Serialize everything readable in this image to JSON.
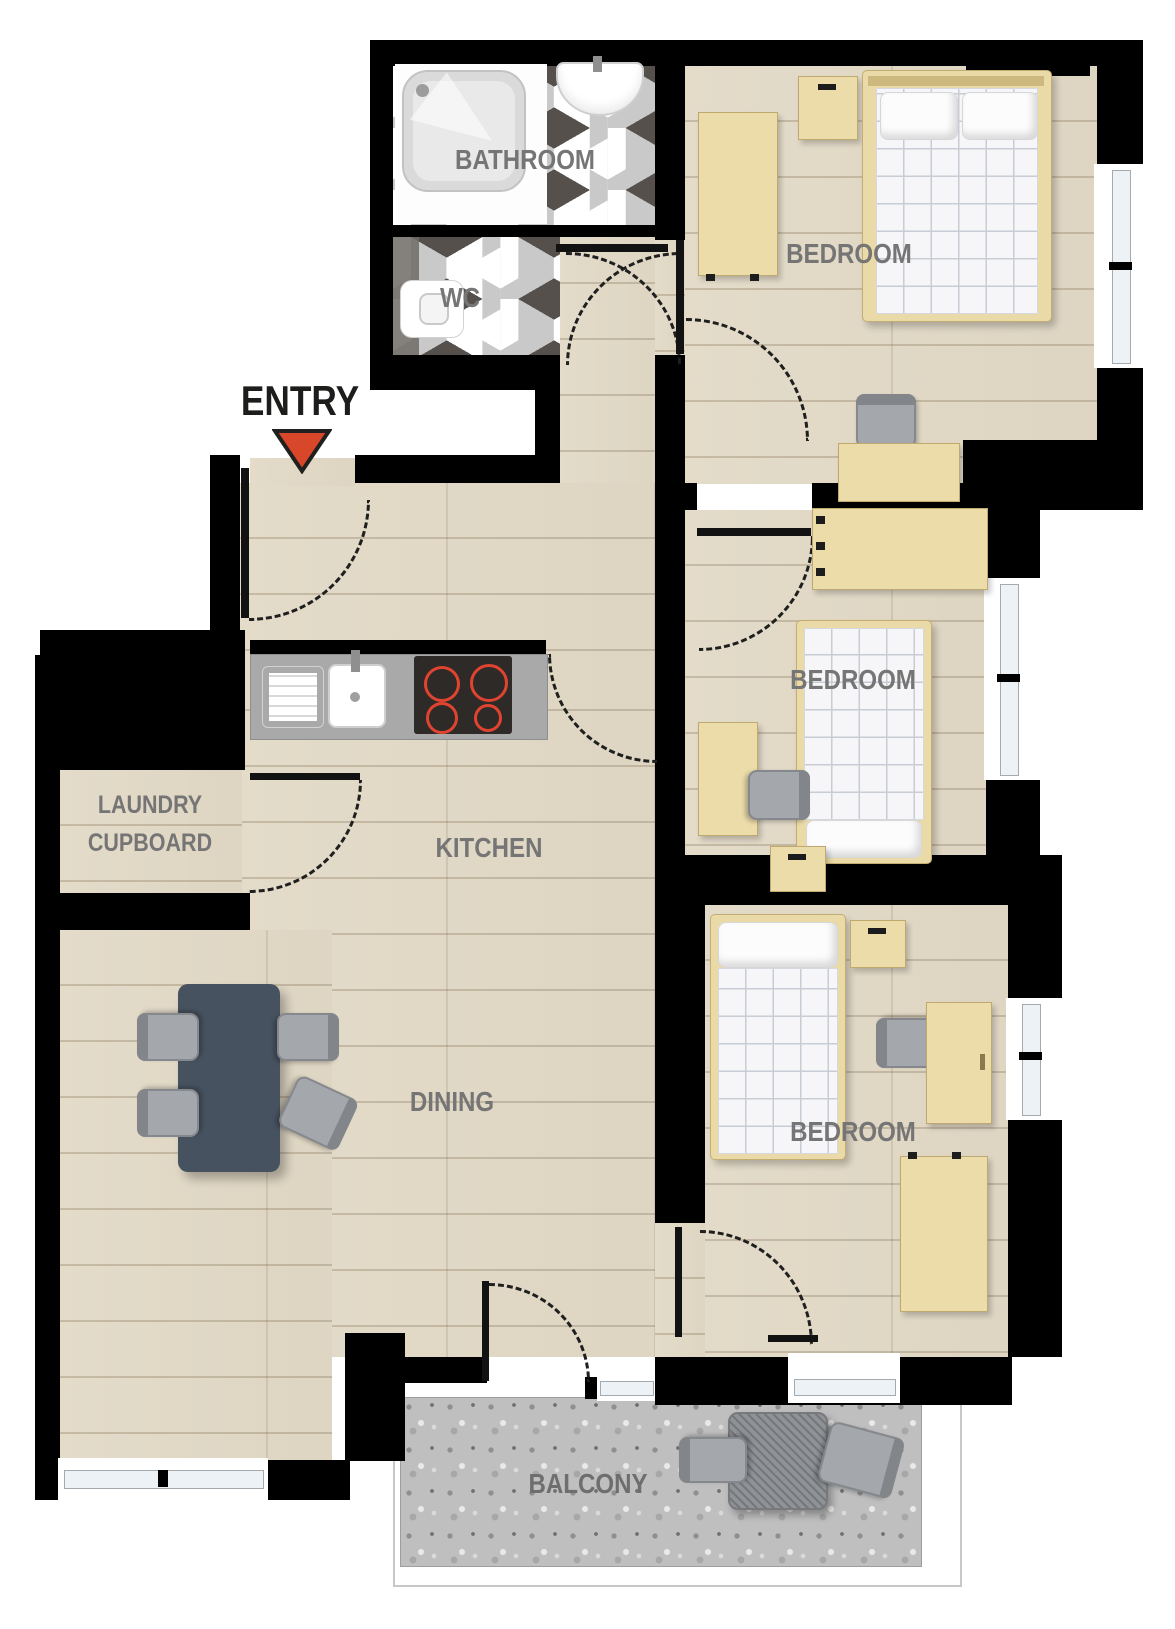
{
  "entry": {
    "label": "ENTRY"
  },
  "rooms": {
    "bathroom": {
      "label": "BATHROOM",
      "fixtures": [
        "shower",
        "basin"
      ]
    },
    "wc": {
      "label": "WC",
      "fixtures": [
        "toilet"
      ]
    },
    "bedroom_top": {
      "label": "BEDROOM",
      "furniture": [
        "double-bed",
        "two-pillows",
        "wardrobe",
        "bedside-table",
        "desk",
        "chair"
      ]
    },
    "bedroom_middle": {
      "label": "BEDROOM",
      "furniture": [
        "single-bed",
        "pillow",
        "wardrobe",
        "desk",
        "chair",
        "bedside-table"
      ]
    },
    "bedroom_bottom": {
      "label": "BEDROOM",
      "furniture": [
        "single-bed",
        "pillow",
        "wardrobe",
        "desk",
        "chair",
        "bedside-table"
      ]
    },
    "kitchen": {
      "label": "KITCHEN",
      "fixtures": [
        "counter",
        "sink",
        "drainer",
        "hob-4-burners"
      ]
    },
    "laundry_cupboard": {
      "line1": "LAUNDRY",
      "line2": "CUPBOARD"
    },
    "dining": {
      "label": "DINING",
      "furniture": [
        "dining-table",
        "chair",
        "chair",
        "chair",
        "chair"
      ]
    },
    "balcony": {
      "label": "BALCONY",
      "furniture": [
        "outdoor-table",
        "chair",
        "chair"
      ]
    }
  },
  "doors": [
    "entry-door",
    "bathroom-door",
    "wc-door",
    "bedroom-top-door",
    "bedroom-middle-door",
    "bedroom-bottom-door",
    "laundry-door",
    "kitchen-opening",
    "balcony-door"
  ],
  "windows": [
    "bedroom-top-window",
    "bedroom-middle-window",
    "bedroom-bottom-window",
    "bedroom-bottom-south-window",
    "dining-south-window",
    "dining-balcony-window"
  ],
  "colors": {
    "wall": "#000000",
    "wood_floor": "#e2d9c6",
    "plank_line": "#b9ab92",
    "tile_white": "#ffffff",
    "tile_light": "#c9c9c9",
    "tile_dark": "#55504b",
    "furniture_wood": "#ecdcaa",
    "mattress": "#f6f6f8",
    "mattress_grid": "#c7ccd5",
    "pillow": "#fcfcfd",
    "counter": "#a9a9a9",
    "hob": "#2e2a27",
    "burner_ring": "#e04430",
    "dining_table": "#475260",
    "chair": "#a4a7ac",
    "balcony_floor": "#bfbfbf",
    "label_text": "#757575",
    "entry_text": "#1d1d1b",
    "entry_arrow": "#d9472b",
    "window_glass": "#edf2f6"
  }
}
